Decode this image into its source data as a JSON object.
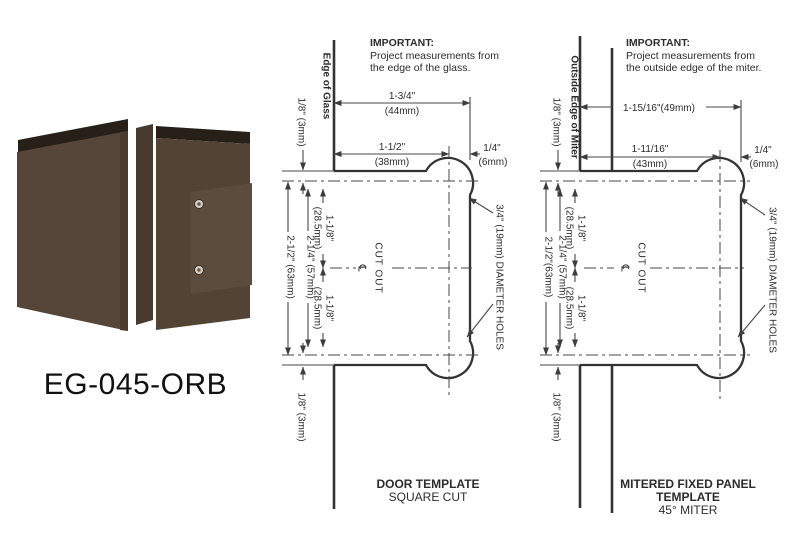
{
  "page": {
    "background": "#ffffff",
    "ink": "#3a3a3a"
  },
  "product": {
    "code": "EG-045-ORB",
    "finish_colors": {
      "body": "#564639",
      "body_right": "#524335",
      "clamp_edge": "#262019",
      "cover": "#5c4c3e",
      "screw": "#d6d0c8"
    }
  },
  "door_template": {
    "edge_label": "Edge of Glass",
    "important": {
      "heading": "IMPORTANT:",
      "line1": "Project measurements from",
      "line2": "the edge of the glass."
    },
    "dims": {
      "width_overall": "1-3/4\"",
      "width_overall_mm": "(44mm)",
      "width_to_center": "1-1/2\"",
      "width_to_center_mm": "(38mm)",
      "center_to_edge": "1/4\"",
      "center_to_edge_mm": "(6mm)",
      "top_offset": "1/8\" (3mm)",
      "height_overall": "2-1/2\" (63mm)",
      "height_centers": "2-1/4\" (57mm)",
      "center_upper": "1-1/8\"",
      "center_upper_mm": "(28.5mm)",
      "center_lower": "1-1/8\"",
      "center_lower_mm": "(28.5mm)",
      "bottom_offset": "1/8\" (3mm)"
    },
    "cutout_label": "CUT OUT",
    "centerline_symbol": "℄",
    "holes_label": "3/4\" (19mm) DIAMETER HOLES",
    "title_line1": "DOOR TEMPLATE",
    "title_line2": "SQUARE CUT"
  },
  "miter_template": {
    "edge_label": "Outside Edge of Miter",
    "important": {
      "heading": "IMPORTANT:",
      "line1": "Project measurements from",
      "line2": "the outside edge of the miter."
    },
    "dims": {
      "width_overall": "1-15/16\"(49mm)",
      "width_to_center": "1-11/16\"",
      "width_to_center_mm": "(43mm)",
      "center_to_edge": "1/4\"",
      "center_to_edge_mm": "(6mm)",
      "top_offset": "1/8\" (3mm)",
      "height_overall": "2-1/2\"(63mm)",
      "height_centers": "2-1/4\" (57mm)",
      "center_upper": "1-1/8\"",
      "center_upper_mm": "(28.5mm)",
      "center_lower": "1-1/8\"",
      "center_lower_mm": "(28.5mm)",
      "bottom_offset": "1/8\" (3mm)"
    },
    "cutout_label": "CUT OUT",
    "centerline_symbol": "℄",
    "holes_label": "3/4\" (19mm) DIAMETER HOLES",
    "title_line1": "MITERED FIXED PANEL",
    "title_line2": "TEMPLATE",
    "title_line3": "45° MITER"
  }
}
